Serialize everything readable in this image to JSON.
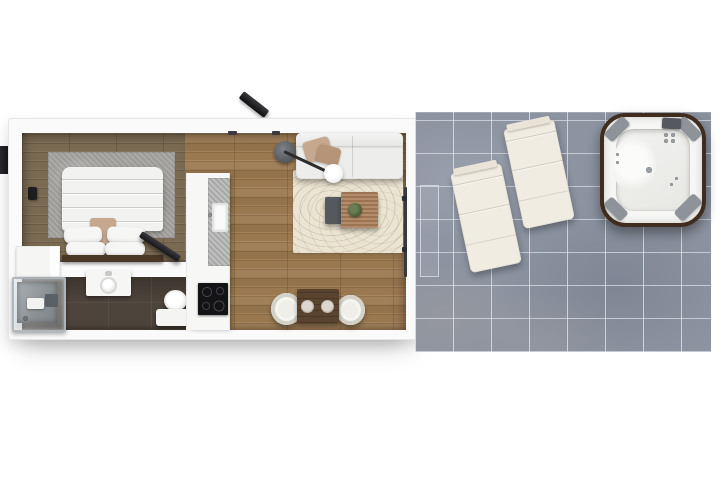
{
  "scene": {
    "title": "3D top-down floor plan render of a studio apartment with terrace",
    "palette": {
      "page_bg": "#ffffff",
      "wall": "#fafafa",
      "wall_edge": "#e6e6e6",
      "wood_living": "#9b7950",
      "wood_bedroom": "#7b6a52",
      "bathroom_floor": "#4d443b",
      "terrace_tile": "#8c93a1",
      "terrace_grout": "#dfe3ea",
      "rug_living": "#ebe4d2",
      "rug_bedroom": "#a7a5a2",
      "white_furniture": "#f2f2f0",
      "sofa": "#ededeb",
      "pillow_tan": "#c5a88e",
      "headboard": "#4a3827",
      "table_wood": "#a97f5b",
      "side_table": "#55585c",
      "dining_wood": "#5a432f",
      "chair": "#e9e7e2",
      "counter": "#b5b5b5",
      "cooktop": "#141416",
      "lounger": "#f0ece1",
      "tub_rim": "#3f2d20",
      "tub_shell": "#f6f6f4",
      "tub_pad": "#8e939a",
      "black_accent": "#1d1d1f",
      "dark_floor_shelf": "#5a6065"
    }
  },
  "labels": {
    "plan": "Studio apartment floor plan",
    "bedroom": "Bedroom",
    "bedroom_rug": "Bedroom rug",
    "bed": "Double bed",
    "pillow": "Pillow",
    "throw": "Folded throw",
    "headboard": "Headboard",
    "wall_lamp": "Bedroom wall lamp",
    "tv": "Wall-mounted TV",
    "side_tv": "TV panel",
    "wardrobe": "Wardrobe",
    "bathroom": "Bathroom",
    "shower": "Walk-in shower",
    "shower_fixture": "Shower fixture",
    "shower_shelf": "Shower shelf",
    "washbasin": "Washbasin vanity",
    "toilet": "Toilet",
    "kitchen": "Kitchenette",
    "kitchen_counter": "Kitchen counter",
    "kitchen_sink": "Kitchen sink",
    "cooktop": "Induction cooktop",
    "living": "Living area",
    "sofa": "Sofa",
    "sofa_pillow": "Sofa cushion",
    "arc_lamp": "Arc floor lamp",
    "living_rug": "Living room rug",
    "coffee_table": "Coffee table",
    "side_table": "Nesting side table",
    "plant": "Potted plant",
    "dining_table": "Dining table for two",
    "dining_chair": "Dining chair",
    "place_setting": "Place setting",
    "entry_door": "Entrance door",
    "entry_lamp": "Entrance light",
    "sliding_door": "Sliding glass door to terrace",
    "terrace": "Tiled terrace",
    "door_mat": "Terrace step",
    "lounger": "Sun lounger",
    "hot_tub": "Hot tub",
    "tub_pad": "Headrest pad",
    "tub_panel": "Control panel",
    "jet": "Water jet"
  }
}
